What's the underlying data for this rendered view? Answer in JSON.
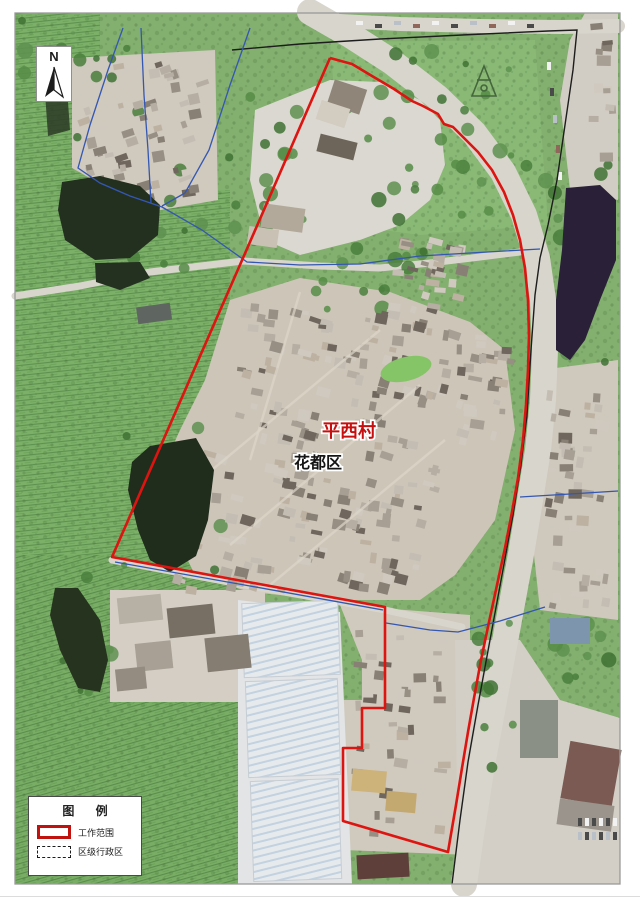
{
  "map": {
    "place_labels": {
      "village": "平西村",
      "district": "花都区"
    },
    "north_arrow": {
      "letter": "N"
    },
    "legend": {
      "title": "图 例",
      "items": [
        {
          "label": "工作范围"
        },
        {
          "label": "区级行政区"
        }
      ]
    },
    "colors": {
      "work_scope": "#dd1410",
      "admin_boundary": "#3457b2",
      "road_axis": "#1d1d1d",
      "village_label": "#c80f0f",
      "district_label": "#151515"
    },
    "boundaries": {
      "work_scope_points": "330,58 352,64 372,76 394,89 412,101 423,106 438,114 444,124 453,127 463,137 478,152 492,170 504,192 513,215 520,240 525,268 528,300 529,335 528,370 526,405 523,440 518,478 512,512 505,548 497,585 489,622 481,660 474,698 468,732 462,768 456,805 450,840 448,852 343,821 343,748 362,748 362,708 385,708 385,607 248,582 112,557 243,258 330,58",
      "road_axis_points": "232,50 300,44 380,39 462,35 548,31 577,30 573,70 565,125 557,180 548,225 540,258 535,295 531,350 527,415 521,465 513,515 502,575 490,640 478,705 468,762 460,820 452,884",
      "admin_lines": [
        "123,28 108,70 90,125 78,168 100,183 130,196 162,207 202,230 247,262 300,265 360,264 420,256 470,253 540,249",
        "141,28 144,95 148,150 151,203",
        "250,28 230,85 209,150 185,193 162,206",
        "520,497 570,494 618,491",
        "386,623 430,630 458,632 500,621 545,607",
        "115,562 250,586 383,610"
      ]
    }
  }
}
